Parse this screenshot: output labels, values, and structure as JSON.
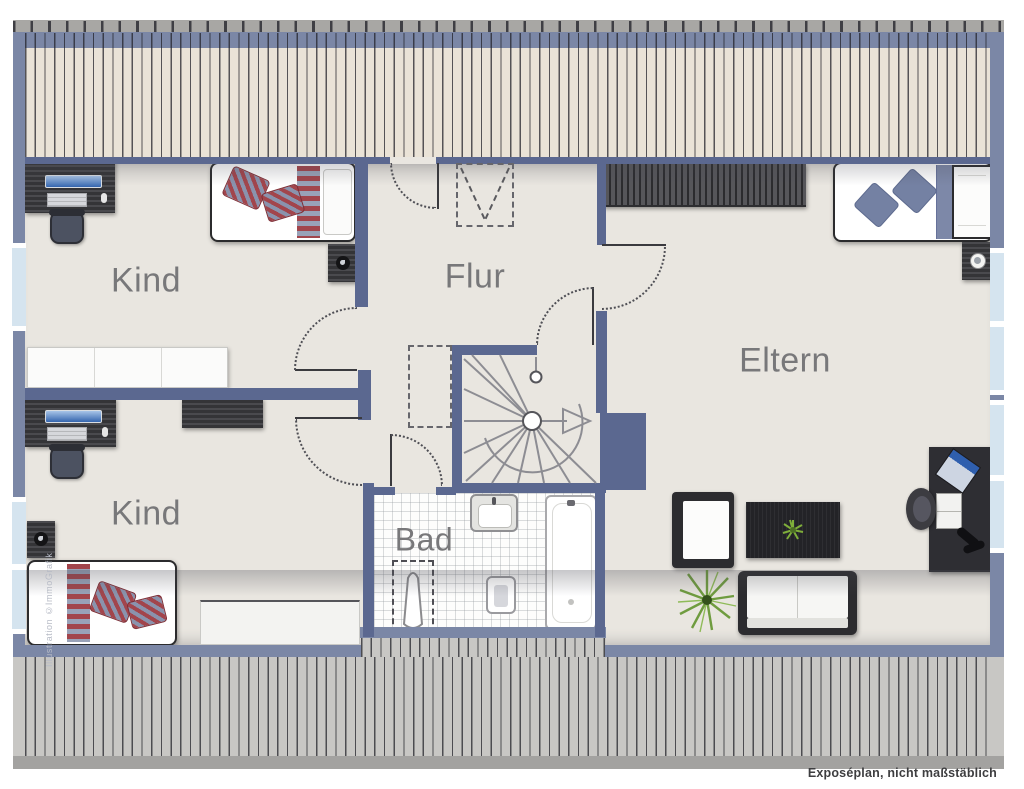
{
  "plan": {
    "type": "floorplan-attic-storey",
    "rooms": [
      {
        "id": "kind-top",
        "label": "Kind"
      },
      {
        "id": "flur",
        "label": "Flur"
      },
      {
        "id": "kind-bottom",
        "label": "Kind"
      },
      {
        "id": "bad",
        "label": "Bad"
      },
      {
        "id": "eltern",
        "label": "Eltern"
      }
    ],
    "caption": "Exposéplan, nicht maßstäblich",
    "credit": "Illustration ©ImmoGrafik",
    "symbols": [
      "spiral-staircase",
      "roof-window-dashed",
      "door-swing-arcs",
      "knee-wall-hatching",
      "roof-slope-hatching"
    ],
    "furniture": {
      "kind_top": [
        "desk",
        "office-chair",
        "single-bed",
        "nightstand-with-lamp"
      ],
      "kind_bottom": [
        "wall-sideboard",
        "desk",
        "office-chair",
        "tv-lowboard",
        "nightstand-with-lamp",
        "single-bed",
        "lowboard"
      ],
      "bad": [
        "sink",
        "bathtub",
        "toilet",
        "bidet"
      ],
      "eltern": [
        "wardrobe",
        "double-bed",
        "nightstand-with-lamp",
        "armchair",
        "coffee-table-with-plant",
        "sofa",
        "potted-plant",
        "desk-with-laptop",
        "desk-chair"
      ]
    }
  },
  "colors": {
    "wall_exterior": "#7b87a6",
    "wall_interior": "#5b6890",
    "floor": "#e9e6e0",
    "roof_band_top": "#eae3d7",
    "roof_band_bottom": "#c8c7c4",
    "ridge_strip": "#a8a7a4",
    "window_glass": "#d5e4ef",
    "label_text": "#78787a",
    "textile_red": "#a2454c",
    "textile_blue": "#7d88a8",
    "plant_green": "#6f9c3f"
  }
}
